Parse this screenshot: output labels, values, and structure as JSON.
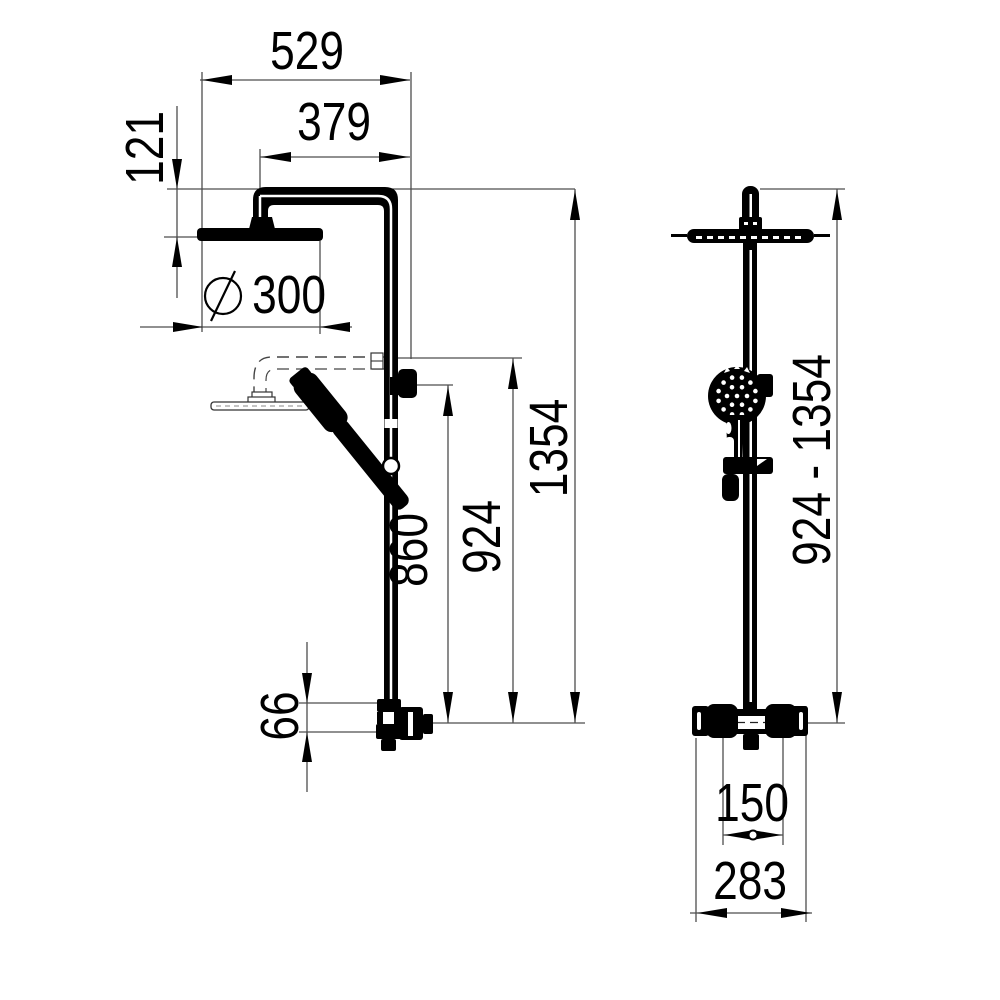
{
  "drawing": {
    "product": "thermostatic shower column with overhead rain shower and hand shower",
    "type": "dimensioned technical drawing, side view and front view",
    "colors": {
      "object": "#000000",
      "dimension_lines": "#4d4d4d",
      "text": "#000000",
      "background": "#ffffff"
    },
    "views": {
      "side_view": {
        "dimensions": {
          "overall_width": "529",
          "arm_reach": "379",
          "head_drop": "121",
          "diameter_symbol": "⌀",
          "head_diameter": "300",
          "total_height": "1354",
          "riser_height": "924",
          "slider_height": "860",
          "outlet_drop": "66"
        }
      },
      "front_view": {
        "dimensions": {
          "height_range": "924 - 1354",
          "inlet_spacing": "150",
          "valve_width": "283"
        }
      }
    }
  }
}
